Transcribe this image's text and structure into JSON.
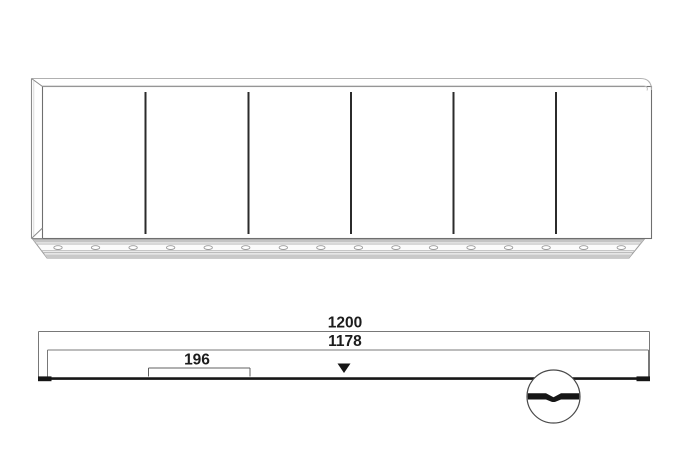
{
  "drawing": {
    "kind": "furniture-technical-drawing",
    "background_color": "#ffffff",
    "outline_color": "#6f6f6f",
    "light_line_color": "#b0b0b0",
    "divider_color": "#2b2b2b",
    "dimension_line_color": "#787878",
    "bar_color": "#161616",
    "text_color": "#1c1c1c"
  },
  "front_view": {
    "description": "cabinet-front-elevation",
    "door_sections": 6,
    "divider_xs": [
      145.5,
      248.5,
      351,
      453.5,
      556
    ],
    "divider_y1": 92,
    "divider_y2": 234,
    "plinth_slots": {
      "count": 16,
      "first_x": 58,
      "step": 37.55,
      "cy": 247.6,
      "rx": 4.2,
      "ry": 1.9
    }
  },
  "dimension_view": {
    "labels": {
      "overall": "1200",
      "inner": "1178",
      "offset": "196"
    },
    "marker": "center-triangle-marker",
    "detail": "plinth-joint-detail-circle"
  }
}
